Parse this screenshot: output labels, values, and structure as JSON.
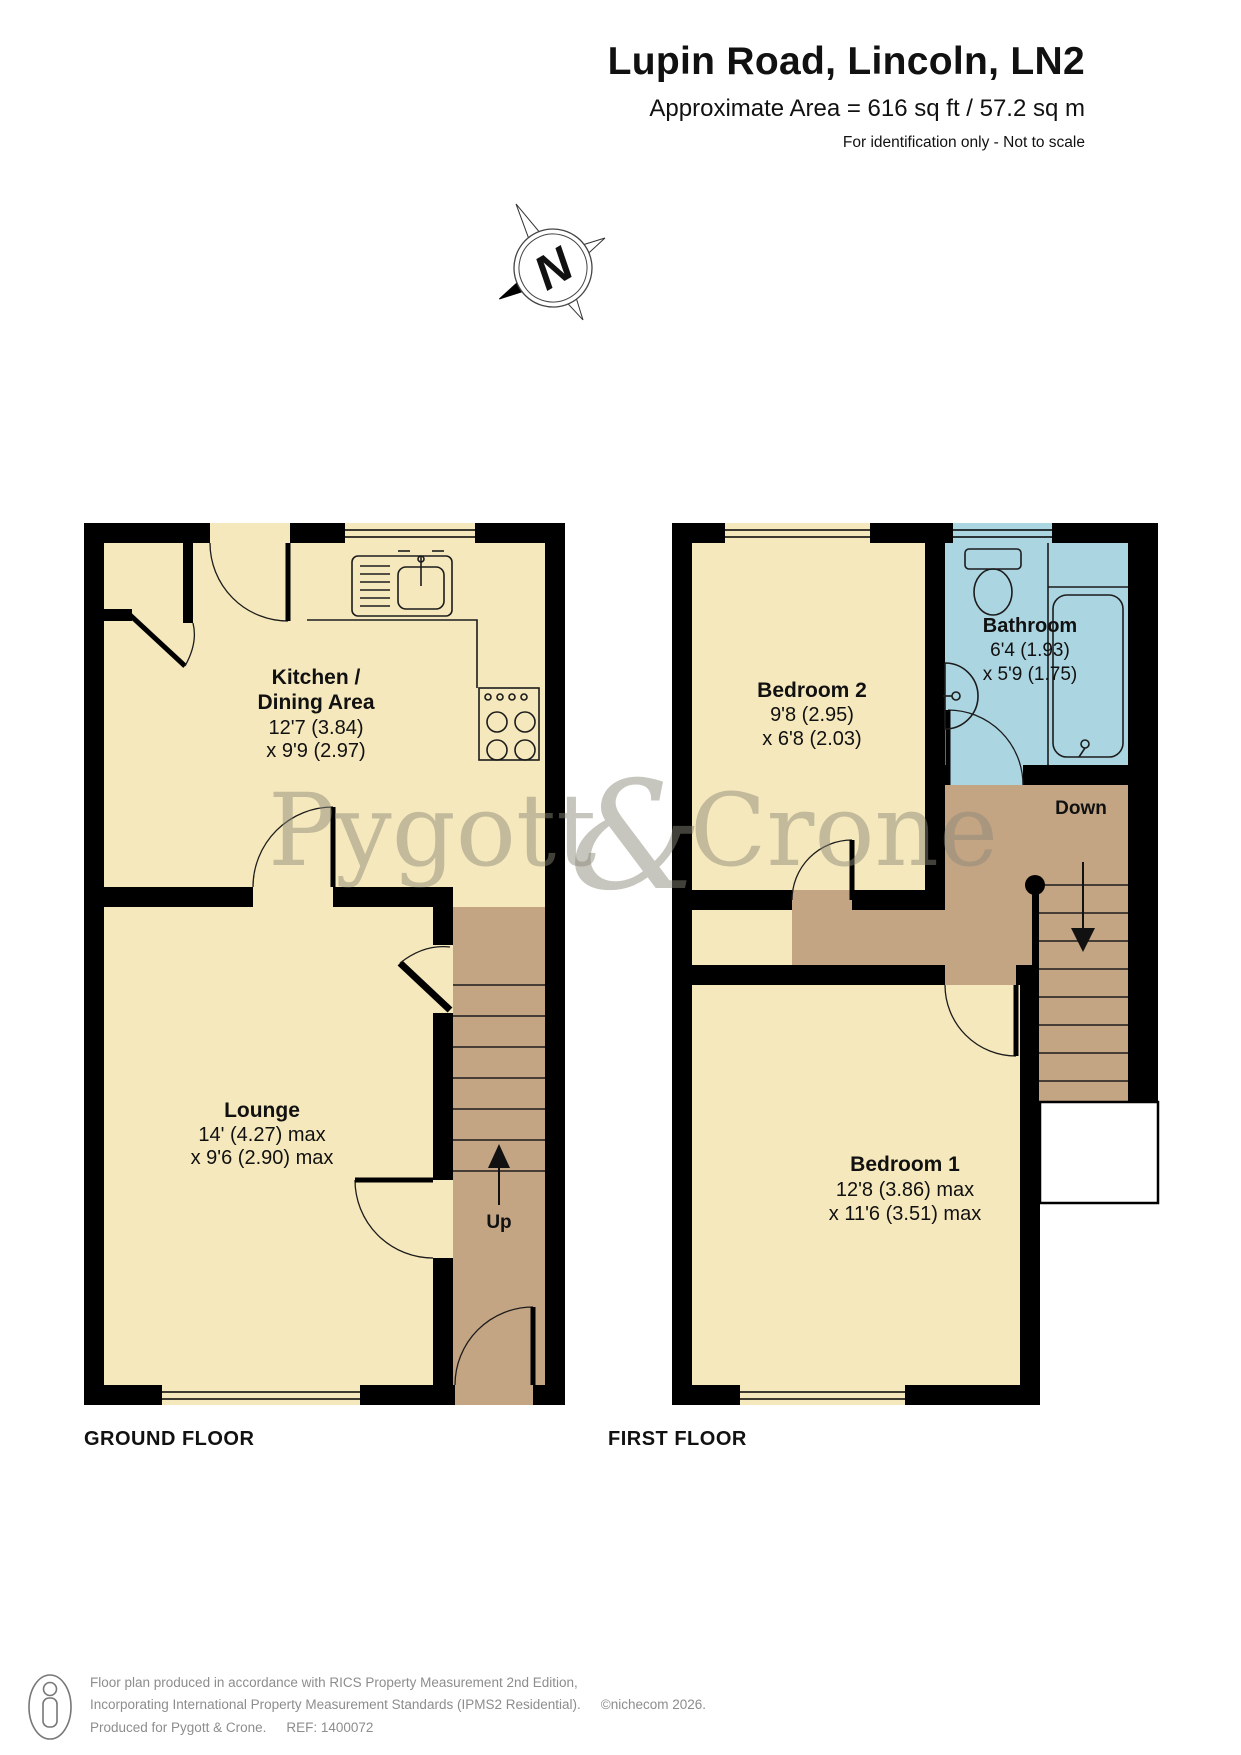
{
  "header": {
    "title": "Lupin Road, Lincoln, LN2",
    "area": "Approximate Area = 616 sq ft / 57.2 sq m",
    "disclaimer": "For identification only - Not to scale"
  },
  "compass": {
    "letter": "N"
  },
  "watermark": {
    "part1": "Pygott",
    "amp": "&",
    "part2": "Crone"
  },
  "ground_floor": {
    "label": "GROUND FLOOR",
    "rooms": {
      "kitchen": {
        "name_line1": "Kitchen /",
        "name_line2": "Dining Area",
        "dim1": "12'7 (3.84)",
        "dim2": "x 9'9 (2.97)"
      },
      "lounge": {
        "name": "Lounge",
        "dim1": "14' (4.27) max",
        "dim2": "x 9'6 (2.90) max"
      },
      "stairs": {
        "label": "Up"
      }
    }
  },
  "first_floor": {
    "label": "FIRST FLOOR",
    "rooms": {
      "bedroom2": {
        "name": "Bedroom 2",
        "dim1": "9'8 (2.95)",
        "dim2": "x 6'8 (2.03)"
      },
      "bathroom": {
        "name": "Bathroom",
        "dim1": "6'4 (1.93)",
        "dim2": "x 5'9 (1.75)"
      },
      "bedroom1": {
        "name": "Bedroom 1",
        "dim1": "12'8 (3.86) max",
        "dim2": "x 11'6 (3.51) max"
      },
      "stairs": {
        "label": "Down"
      }
    }
  },
  "footer": {
    "line1": "Floor plan produced in accordance with RICS Property Measurement 2nd Edition,",
    "line2": "Incorporating International Property Measurement Standards (IPMS2 Residential).",
    "copyright": "©nichecom 2026.",
    "line3_produced": "Produced for Pygott & Crone.",
    "line3_ref": "REF: 1400072"
  },
  "colors": {
    "room": "#F5E8BC",
    "hall": "#C3A584",
    "bathroom": "#ACD5E2",
    "wall": "#000000",
    "watermark": "#8B8978"
  }
}
